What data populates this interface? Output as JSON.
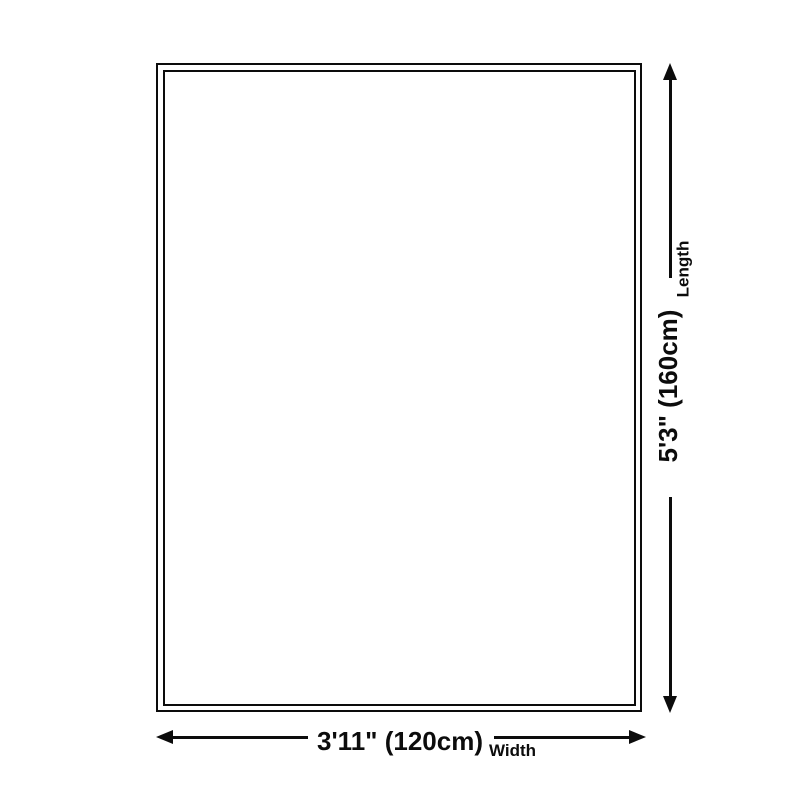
{
  "diagram": {
    "width_value": "3'11\" (120cm)",
    "width_label": "Width",
    "length_value": "5'3\" (160cm)",
    "length_label": "Length"
  },
  "colors": {
    "ink": "#0c0c0c",
    "background": "#ffffff"
  }
}
